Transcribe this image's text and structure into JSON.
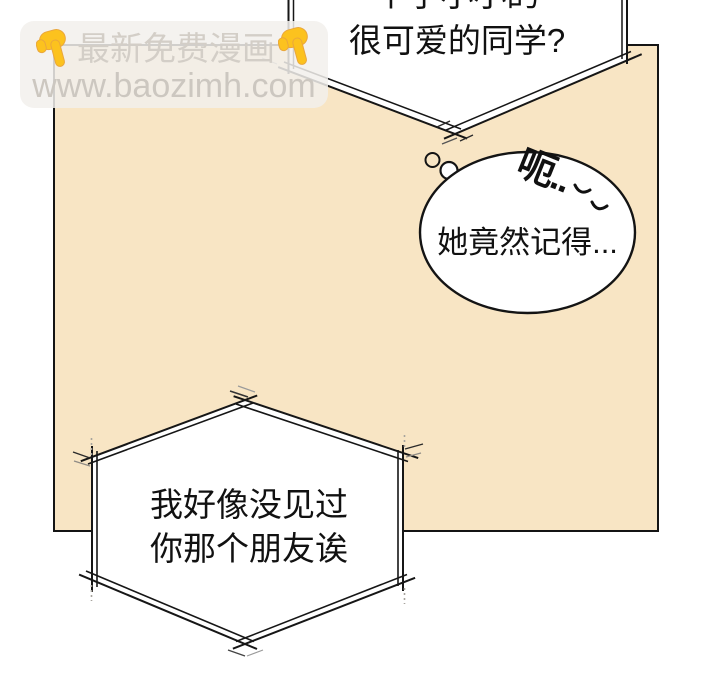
{
  "page": {
    "background": "#ffffff",
    "ink": "#111111",
    "panel_fill": "#f8e5c4"
  },
  "watermark": {
    "title": "最新免费漫画",
    "url": "www.baozimh.com",
    "icon": "backhand-index-pointing-down",
    "icon_color": "#fcc21e",
    "text_color": "#d3cec7"
  },
  "bubbles": {
    "top_speech": {
      "line1": "个子小小的",
      "line2": "很可爱的同学?"
    },
    "thought": {
      "text": "她竟然记得...",
      "annotation": "呃.."
    },
    "bottom_speech": {
      "line1": "我好像没见过",
      "line2": "你那个朋友诶"
    }
  }
}
